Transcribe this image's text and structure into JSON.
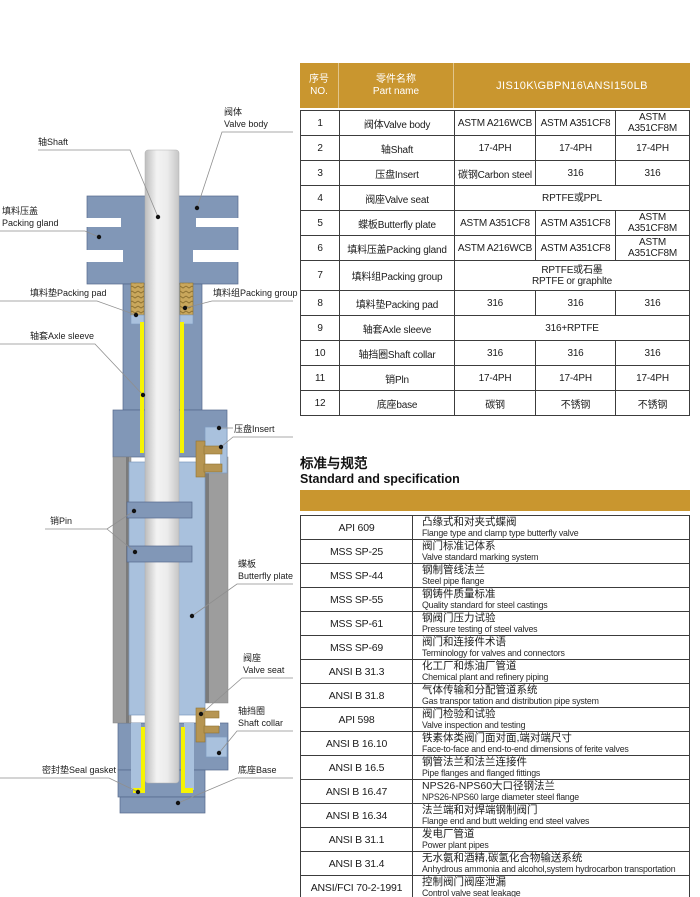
{
  "colors": {
    "accent_gold": "#C9962F",
    "steel_blue": "#8197B7",
    "light_blue": "#A9C1DD",
    "packing_tan": "#C9A75C",
    "sleeve_yellow": "#F6F303",
    "bore_gray": "#9D9D9D"
  },
  "diagram": {
    "labels": {
      "valve_body": {
        "line1": "阀体",
        "line2": "Valve body"
      },
      "shaft": {
        "line1": "轴Shaft"
      },
      "packing_gland": {
        "line1": "填料压盖",
        "line2": "Packing gland"
      },
      "packing_pad": {
        "line1": "填料垫Packing pad"
      },
      "packing_group": {
        "line1": "填料组Packing group"
      },
      "axle_sleeve": {
        "line1": "轴套Axle sleeve"
      },
      "insert": {
        "line1": "压盘Insert"
      },
      "pin": {
        "line1": "销Pin"
      },
      "butterfly_plate": {
        "line1": "蝶板",
        "line2": "Butterfly plate"
      },
      "valve_seat": {
        "line1": "阀座",
        "line2": "Valve seat"
      },
      "shaft_collar": {
        "line1": "轴挡圈",
        "line2": "Shaft collar"
      },
      "seal_gasket": {
        "line1": "密封垫Seal gasket"
      },
      "base": {
        "line1": "底座Base"
      }
    }
  },
  "parts_table": {
    "header": {
      "no_zh": "序号",
      "no_en": "NO.",
      "name_zh": "零件名称",
      "name_en": "Part name",
      "spec": "JIS10K\\GBPN16\\ANSI150LB"
    },
    "rows": [
      {
        "no": "1",
        "name": "阀体Valve body",
        "m1": "ASTM A216WCB",
        "m2": "ASTM A351CF8",
        "m3": "ASTM A351CF8M"
      },
      {
        "no": "2",
        "name": "轴Shaft",
        "m1": "17-4PH",
        "m2": "17-4PH",
        "m3": "17-4PH"
      },
      {
        "no": "3",
        "name": "压盘Insert",
        "m1": "碳钢Carbon steel",
        "m2": "316",
        "m3": "316"
      },
      {
        "no": "4",
        "name": "阀座Valve seat",
        "span": "RPTFE或PPL"
      },
      {
        "no": "5",
        "name": "蝶板Butterfly plate",
        "m1": "ASTM A351CF8",
        "m2": "ASTM A351CF8",
        "m3": "ASTM A351CF8M"
      },
      {
        "no": "6",
        "name": "填料压盖Packing gland",
        "m1": "ASTM A216WCB",
        "m2": "ASTM A351CF8",
        "m3": "ASTM A351CF8M"
      },
      {
        "no": "7",
        "name": "填料组Packing group",
        "span": "RPTFE或石墨",
        "span2": "RPTFE or graphlte"
      },
      {
        "no": "8",
        "name": "填料垫Packing pad",
        "m1": "316",
        "m2": "316",
        "m3": "316"
      },
      {
        "no": "9",
        "name": "轴套Axle sleeve",
        "span": "316+RPTFE"
      },
      {
        "no": "10",
        "name": "轴挡圈Shaft collar",
        "m1": "316",
        "m2": "316",
        "m3": "316"
      },
      {
        "no": "11",
        "name": "销Pln",
        "m1": "17-4PH",
        "m2": "17-4PH",
        "m3": "17-4PH"
      },
      {
        "no": "12",
        "name": "底座base",
        "m1": "碳钢",
        "m2": "不锈钢",
        "m3": "不锈钢"
      }
    ]
  },
  "standards": {
    "title_zh": "标准与规范",
    "title_en": "Standard and specification",
    "rows": [
      {
        "code": "API 609",
        "zh": "凸缘式和对夹式蝶阀",
        "en": "Flange type and clamp type butterfly valve"
      },
      {
        "code": "MSS SP-25",
        "zh": "阀门标准记体系",
        "en": "Valve standard marking system"
      },
      {
        "code": "MSS SP-44",
        "zh": "钢制管线法兰",
        "en": "Steel pipe flange"
      },
      {
        "code": "MSS SP-55",
        "zh": "钢铸件质量标准",
        "en": "Quality standard for steel castings"
      },
      {
        "code": "MSS SP-61",
        "zh": "钢阀门压力试验",
        "en": "Pressure testing of steel valves"
      },
      {
        "code": "MSS SP-69",
        "zh": "阀门和连接件术语",
        "en": "Terminology for valves and connectors"
      },
      {
        "code": "ANSI B 31.3",
        "zh": "化工厂和炼油厂管道",
        "en": "Chemical plant and refinery piping"
      },
      {
        "code": "ANSI B 31.8",
        "zh": "气体传输和分配管道系统",
        "en": "Gas transpor tation and distribution pipe system"
      },
      {
        "code": "API 598",
        "zh": "阀门检验和试验",
        "en": "Valve inspection and testing"
      },
      {
        "code": "ANSI B 16.10",
        "zh": "铁素体类阀门面对面,端对端尺寸",
        "en": "Face-to-face and end-to-end dimensions of ferite valves"
      },
      {
        "code": "ANSI B 16.5",
        "zh": "钢管法兰和法兰连接件",
        "en": "Pipe flanges and flanged fittings"
      },
      {
        "code": "ANSI B 16.47",
        "zh": "NPS26-NPS60大口径钢法兰",
        "en": "NPS26-NPS60 large diameter steel flange"
      },
      {
        "code": "ANSI B 16.34",
        "zh": "法兰端和对焊端钢制阀门",
        "en": "Flange end and butt welding end steel valves"
      },
      {
        "code": "ANSI B 31.1",
        "zh": "发电厂管道",
        "en": "Power plant pipes"
      },
      {
        "code": "ANSI B 31.4",
        "zh": "无水氨和酒精,碳氢化合物输送系统",
        "en": "Anhydrous ammonia and alcohol,system hydrocarbon transportation"
      },
      {
        "code": "ANSI/FCI 70-2-1991",
        "zh": "控制阀门阀座泄漏",
        "en": "Control valve seat leakage"
      }
    ]
  }
}
